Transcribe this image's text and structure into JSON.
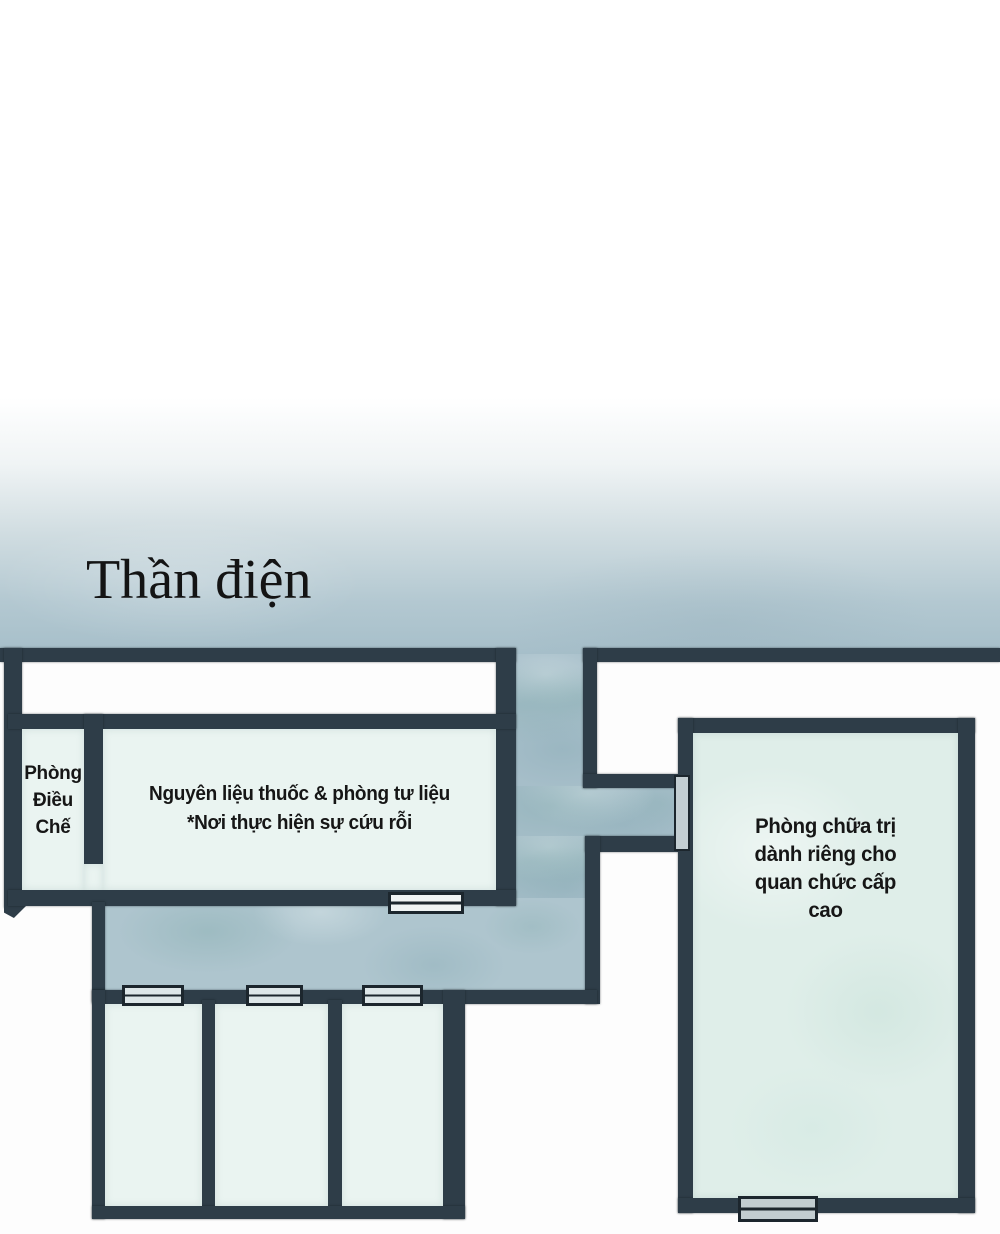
{
  "page": {
    "title": "Thần điện"
  },
  "rooms": {
    "preparation": {
      "label": "Phòng\nĐiều\nChế"
    },
    "materials": {
      "label": "Nguyên liệu thuốc & phòng tư liệu\n*Nơi thực hiện sự cứu rỗi"
    },
    "treatment": {
      "label": "Phòng chữa trị\ndành riêng cho\nquan chức cấp\ncao"
    }
  },
  "colors": {
    "wall": "#2e3d48",
    "blue": "#a6bec9",
    "room": "#eaf4f1",
    "room_alt": "#dfeee9",
    "door": "#c2cdd0",
    "door_light": "#f0f4f4",
    "outline": "#1c262d",
    "text": "#161616"
  }
}
